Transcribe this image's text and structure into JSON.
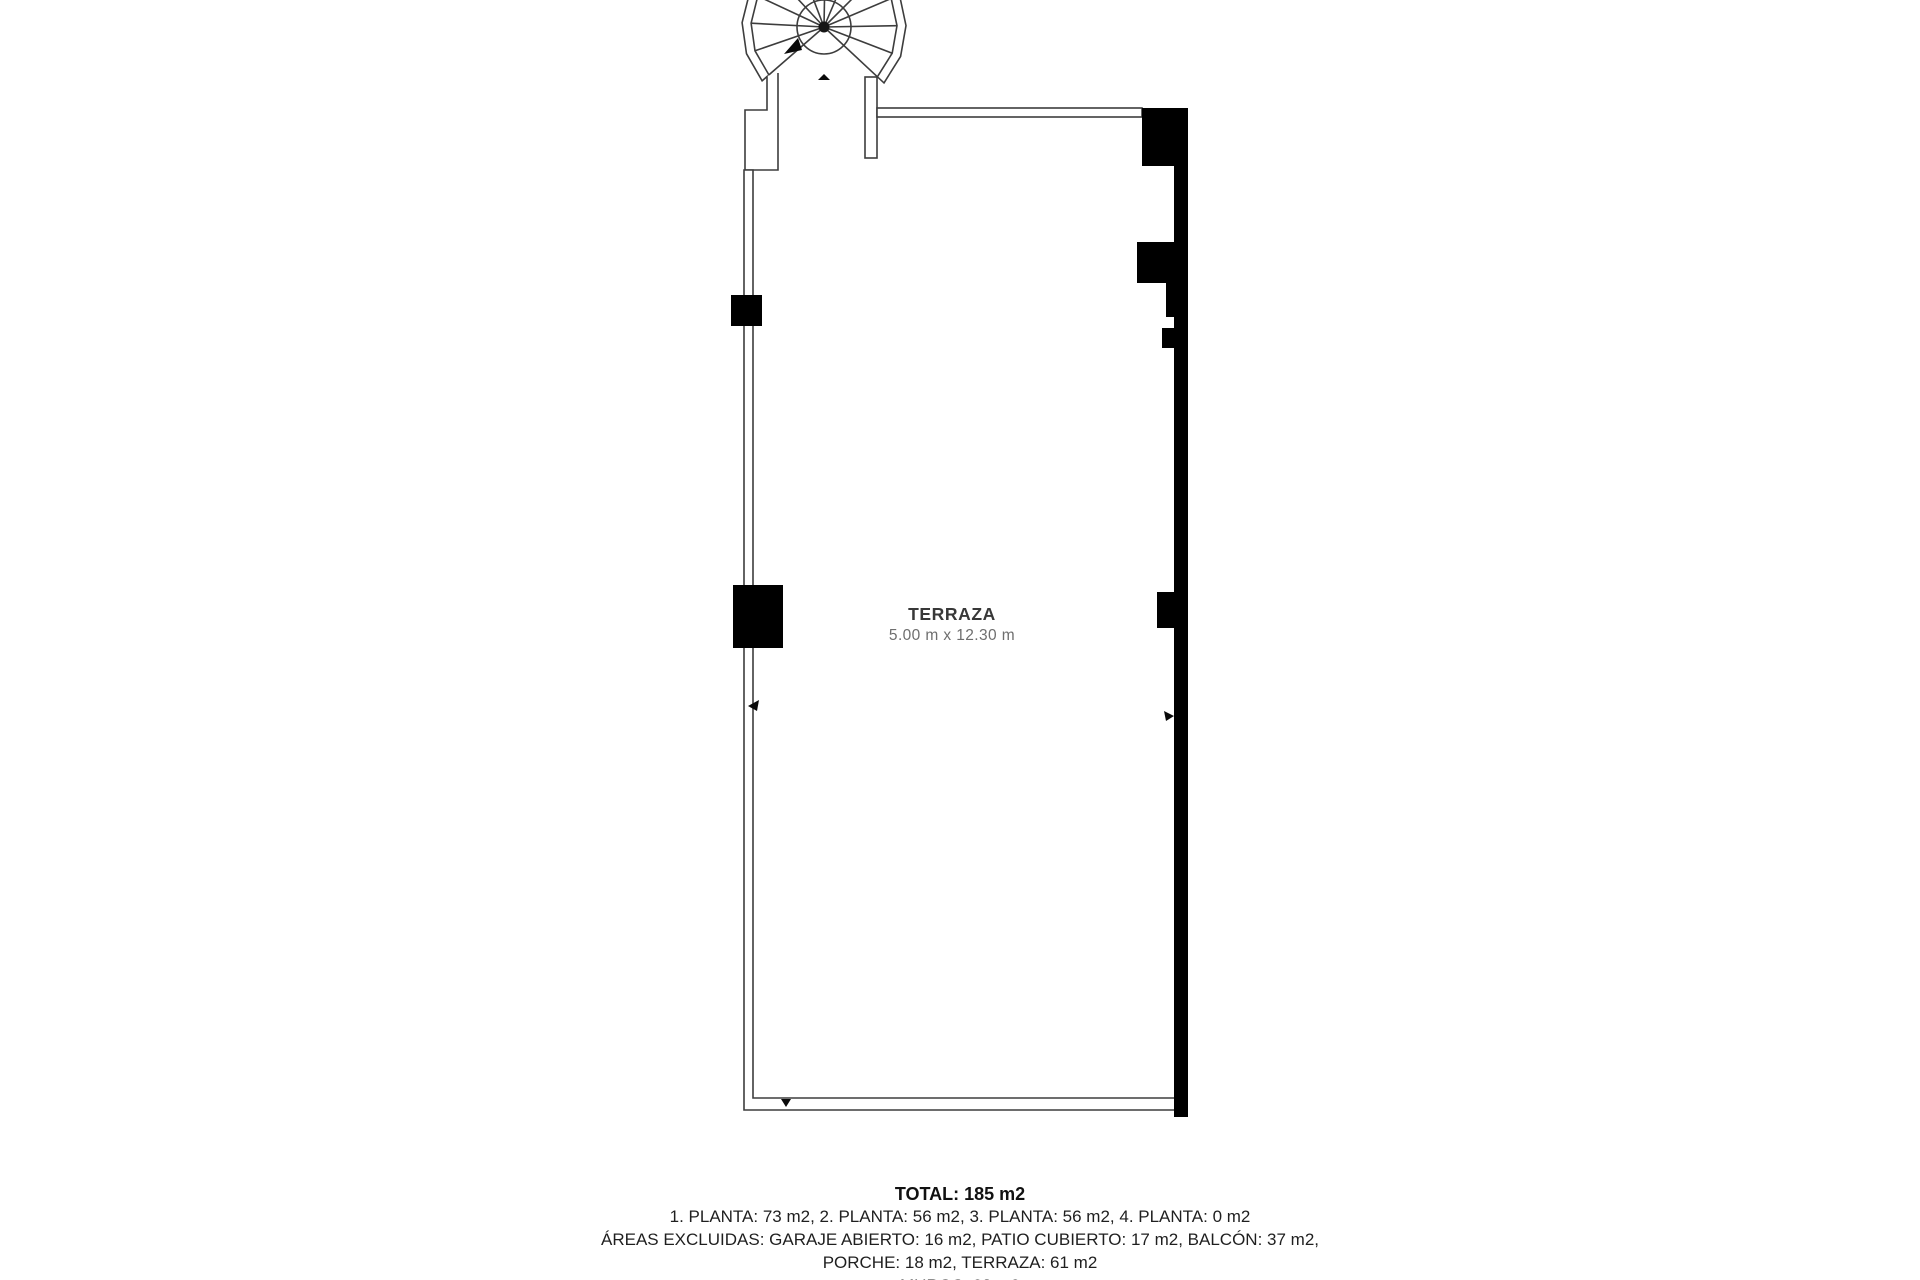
{
  "plan": {
    "room": {
      "label": "TERRAZA",
      "dimensions": "5.00 m x 12.30 m"
    }
  },
  "summary": {
    "total": "TOTAL: 185 m2",
    "lines": [
      "1. PLANTA: 73 m2, 2. PLANTA: 56 m2, 3. PLANTA: 56 m2, 4. PLANTA: 0 m2",
      "ÁREAS EXCLUIDAS: GARAJE ABIERTO: 16 m2, PATIO CUBIERTO: 17 m2, BALCÓN: 37 m2,",
      "PORCHE: 18 m2, TERRAZA: 61 m2",
      "MUROS: 23 m2"
    ]
  },
  "colors": {
    "background": "#ffffff",
    "wall_fill": "#000000",
    "wall_line": "#3d3d3d",
    "text_primary": "#1f1f1f",
    "room_label": "#383838",
    "room_dimensions": "#6e6e6e"
  }
}
